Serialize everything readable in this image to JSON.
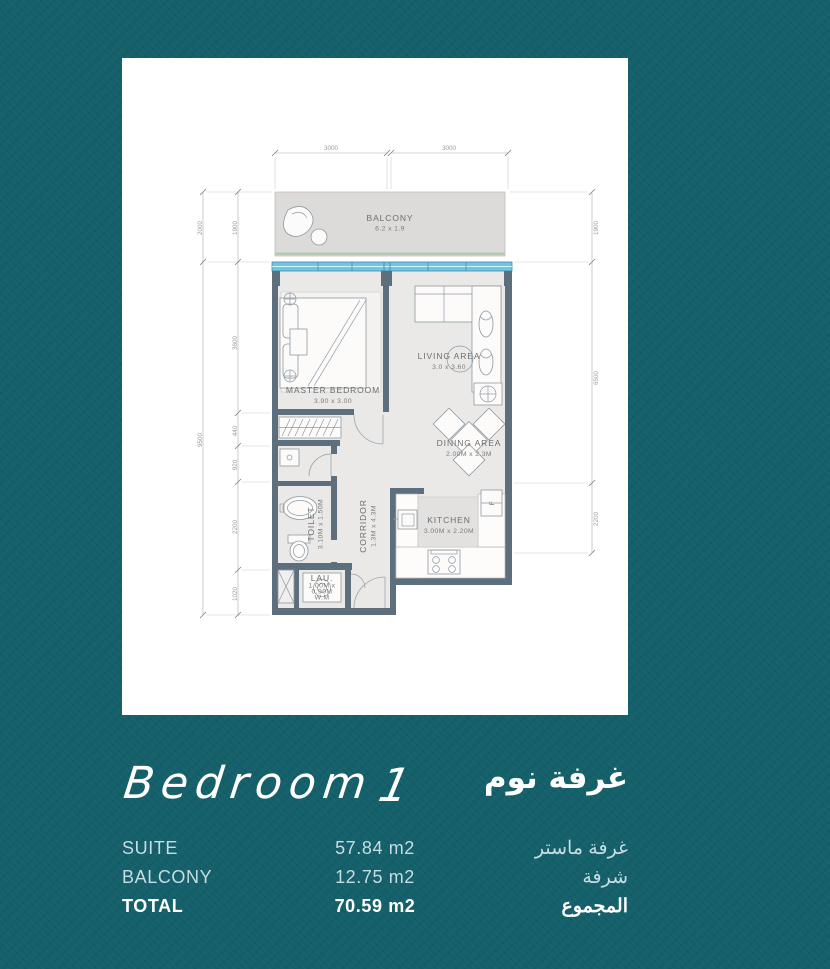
{
  "plan": {
    "rooms": {
      "balcony": {
        "name": "BALCONY",
        "dims": "6.2 x 1.9"
      },
      "master_bedroom": {
        "name": "MASTER BEDROOM",
        "dims": "3.90 x 3.00"
      },
      "living_area": {
        "name": "LIVING AREA",
        "dims": "3.0 x 3.60"
      },
      "dining_area": {
        "name": "DINING AREA",
        "dims": "2.00M x 2.3M"
      },
      "kitchen": {
        "name": "KITCHEN",
        "dims": "3.00M x 2.20M"
      },
      "corridor": {
        "name": "CORRIDOR",
        "dims": "1.3M x 4.3M"
      },
      "toilet": {
        "name": "TOILET",
        "dims": "3.10M x 1.50M"
      },
      "laundry": {
        "name": "LAU.",
        "line1": "1.00M x",
        "line2": "0.90M",
        "line3": "W.M"
      },
      "fridge_label": "F"
    },
    "dims": {
      "top": [
        "3000",
        "3000"
      ],
      "left_outer": [
        "2000",
        "9500"
      ],
      "left_inner": [
        "1900",
        "3600",
        "440",
        "920",
        "2200",
        "1020"
      ],
      "right": [
        "1900",
        "6500",
        "2200"
      ]
    }
  },
  "summary": {
    "title_en": "Bedroom",
    "title_num": "1",
    "title_ar": "غرفة نوم",
    "rows": [
      {
        "label": "SUITE",
        "value": "57.84 m2",
        "label_ar": "غرفة ماستر"
      },
      {
        "label": "BALCONY",
        "value": "12.75 m2",
        "label_ar": "شرفة"
      },
      {
        "label": "TOTAL",
        "value": "70.59 m2",
        "label_ar": "المجموع"
      }
    ]
  },
  "colors": {
    "background_teal": "#14606b",
    "card_white": "#ffffff",
    "wall_slate": "#5d6e7d",
    "window_blue": "#72c5e1",
    "floor_gray": "#eae9e7",
    "row_text": "#c6dde1"
  }
}
